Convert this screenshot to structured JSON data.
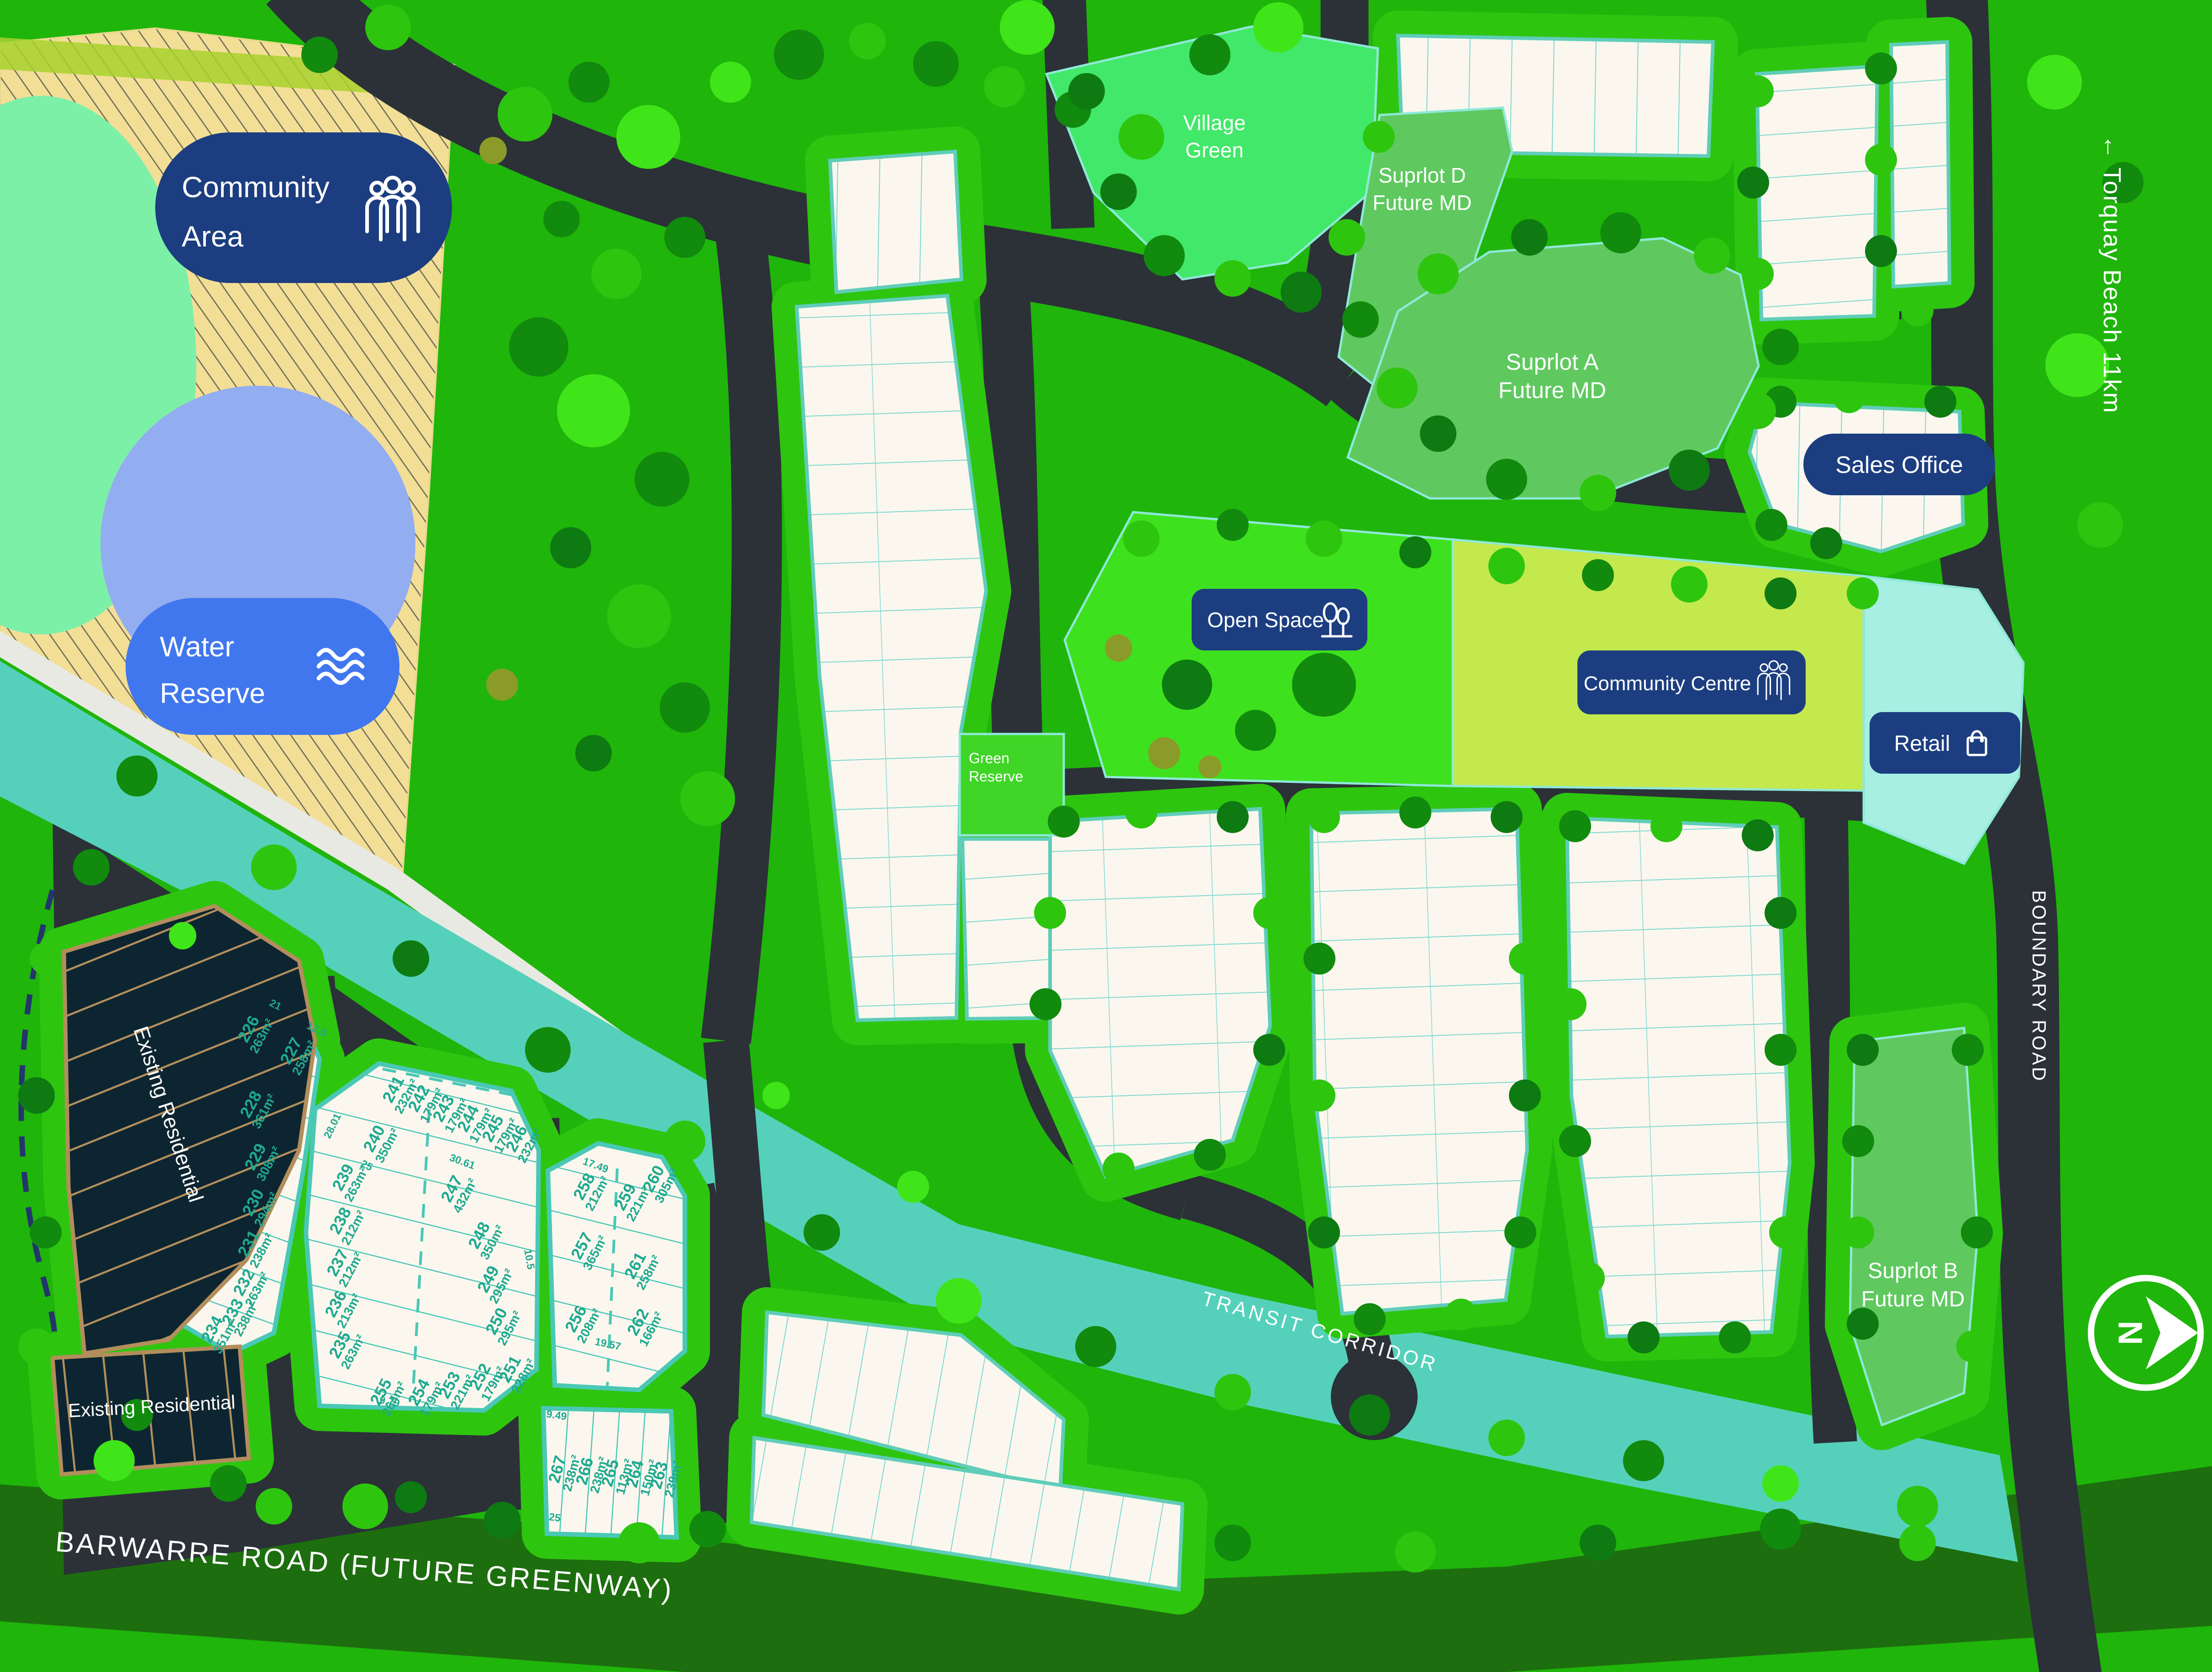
{
  "legend": {
    "community_area": {
      "line1": "Community",
      "line2": "Area",
      "icon": "people-icon",
      "color": "#F9A825"
    },
    "water_reserve": {
      "line1": "Water",
      "line2": "Reserve",
      "icon": "waves-icon",
      "color": "#4177EE"
    }
  },
  "areas": {
    "village_green": {
      "line1": "Village",
      "line2": "Green",
      "color": "#42E869"
    },
    "suprlot_d": {
      "line1": "Suprlot D",
      "line2": "Future MD",
      "color": "#5FC95F"
    },
    "suprlot_a": {
      "line1": "Suprlot A",
      "line2": "Future MD",
      "color": "#5FC95F"
    },
    "suprlot_b": {
      "line1": "Suprlot B",
      "line2": "Future MD",
      "color": "#5FC95F"
    },
    "open_space": {
      "label": "Open Space",
      "icon": "trees-icon",
      "color": "#3EE11D"
    },
    "community_centre": {
      "label": "Community Centre",
      "icon": "people-icon",
      "color": "#C4E94D"
    },
    "retail": {
      "label": "Retail",
      "icon": "bag-icon",
      "color": "#A6EFE2"
    },
    "sales_office": {
      "label": "Sales Office"
    },
    "green_reserve": {
      "line1": "Green",
      "line2": "Reserve",
      "color": "#3FD627"
    },
    "existing_residential_upper": {
      "label": "Existing Residential"
    },
    "existing_residential_lower": {
      "label": "Existing Residential"
    }
  },
  "roads": {
    "boundary_road": "BOUNDARY ROAD",
    "barwarre_road": "BARWARRE ROAD (FUTURE GREENWAY)",
    "transit_corridor": "TRANSIT CORRIDOR",
    "torquay_sign": "← Torquay Beach 11km"
  },
  "compass": {
    "label": "N",
    "icon": "north-arrow-icon"
  },
  "lots": {
    "cluster_a": [
      {
        "n": "226",
        "a": "263m²"
      },
      {
        "n": "227",
        "a": "258m²"
      },
      {
        "n": "228",
        "a": "361m²"
      },
      {
        "n": "229",
        "a": "308m²"
      },
      {
        "n": "230",
        "a": "294m²"
      },
      {
        "n": "231",
        "a": "238m²"
      },
      {
        "n": "232",
        "a": "263m²"
      },
      {
        "n": "233",
        "a": "238m²"
      },
      {
        "n": "234",
        "a": "351m²"
      }
    ],
    "cluster_b": [
      {
        "n": "235",
        "a": "263m²"
      },
      {
        "n": "236",
        "a": "213m²"
      },
      {
        "n": "237",
        "a": "212m²"
      },
      {
        "n": "238",
        "a": "212m²"
      },
      {
        "n": "239",
        "a": "263m²"
      },
      {
        "n": "240",
        "a": "350m²"
      },
      {
        "n": "241",
        "a": "232m²"
      },
      {
        "n": "242",
        "a": "179m²"
      },
      {
        "n": "243",
        "a": "179m²"
      },
      {
        "n": "244",
        "a": "179m²"
      },
      {
        "n": "245",
        "a": "179m²"
      },
      {
        "n": "246",
        "a": "232m²"
      },
      {
        "n": "247",
        "a": "432m²"
      },
      {
        "n": "248",
        "a": "350m²"
      },
      {
        "n": "249",
        "a": "295m²"
      },
      {
        "n": "250",
        "a": "295m²"
      },
      {
        "n": "251",
        "a": "228m²"
      },
      {
        "n": "252",
        "a": "179m²"
      },
      {
        "n": "253",
        "a": "221m²"
      },
      {
        "n": "254",
        "a": "179m²"
      },
      {
        "n": "255",
        "a": "264m²"
      }
    ],
    "cluster_c": [
      {
        "n": "256",
        "a": "208m²"
      },
      {
        "n": "257",
        "a": "365m²"
      },
      {
        "n": "258",
        "a": "212m²"
      },
      {
        "n": "259",
        "a": "221m²"
      },
      {
        "n": "260",
        "a": "305m²"
      },
      {
        "n": "261",
        "a": "258m²"
      },
      {
        "n": "262",
        "a": "166m²"
      }
    ],
    "cluster_d": [
      {
        "n": "263",
        "a": "239m²"
      },
      {
        "n": "264",
        "a": "150m²"
      },
      {
        "n": "265",
        "a": "113m²"
      },
      {
        "n": "266",
        "a": "238m²"
      },
      {
        "n": "267",
        "a": "238m²"
      }
    ]
  },
  "dims": {
    "cluster_a": [
      "21",
      "21",
      "12.5",
      "18",
      "9.5",
      "4.24",
      "25",
      "6.67",
      "2.55",
      "28.01",
      "28.01",
      "11.54",
      "10.5",
      "28",
      "8.5",
      "28",
      "8.5",
      "28",
      "8.5",
      "28",
      "12.5",
      "19.36",
      "13.10",
      "5.87"
    ],
    "cluster_b": [
      "8.24",
      "8.5",
      "8.5",
      "8.5",
      "8.5",
      "8.24",
      "4.24",
      "11.24",
      "5.87",
      "18",
      "25.87",
      "13.10",
      "21",
      "21",
      "21",
      "21",
      "18",
      "21.59",
      "30.61",
      "11.24",
      "9.23",
      "8.65",
      "25",
      "10.5",
      "25",
      "8.5",
      "25",
      "8.5",
      "25",
      "8.5",
      "25",
      "10.5",
      "28",
      "12.5",
      "28",
      "10.5",
      "28",
      "10.5",
      "12.74",
      "18",
      "4.24",
      "9.79",
      "8.5",
      "10.5",
      "8.5",
      "9.71",
      "7.96",
      "72",
      "4.8",
      "10.8",
      "4.25"
    ],
    "cluster_c": [
      "4.24",
      "7.5",
      "11.63",
      "5.87",
      "9.01",
      "21",
      "21",
      "17.49",
      "13.04",
      "17.54",
      "20.13",
      "16",
      "13",
      "19.5",
      "19.96",
      "19.35",
      "17.49",
      "12.5",
      "8.5",
      "19.57"
    ],
    "cluster_d": [
      "9.49",
      "6",
      "4.5",
      "6",
      "9.58",
      "25",
      "25",
      "25",
      "25",
      "25"
    ]
  },
  "colors": {
    "base_green": "#1FB50B",
    "road": "#2B3137",
    "lot_white": "#FBF7EF",
    "lot_line_teal": "#49C8B5",
    "lot_text_teal": "#1FA98F",
    "water_teal": "#55D1BB",
    "hatch_sand": "#F3DE96",
    "water_blob": "#93ADF1",
    "badge_navy": "#1C3E80",
    "badge_orange": "#F9A825",
    "badge_blue": "#4177EE",
    "existing_res_dark": "#0D2530",
    "existing_res_line": "#B28E5C",
    "barwarre_band": "#1D6E0F",
    "pale_green_oval": "#7DF0A8"
  }
}
